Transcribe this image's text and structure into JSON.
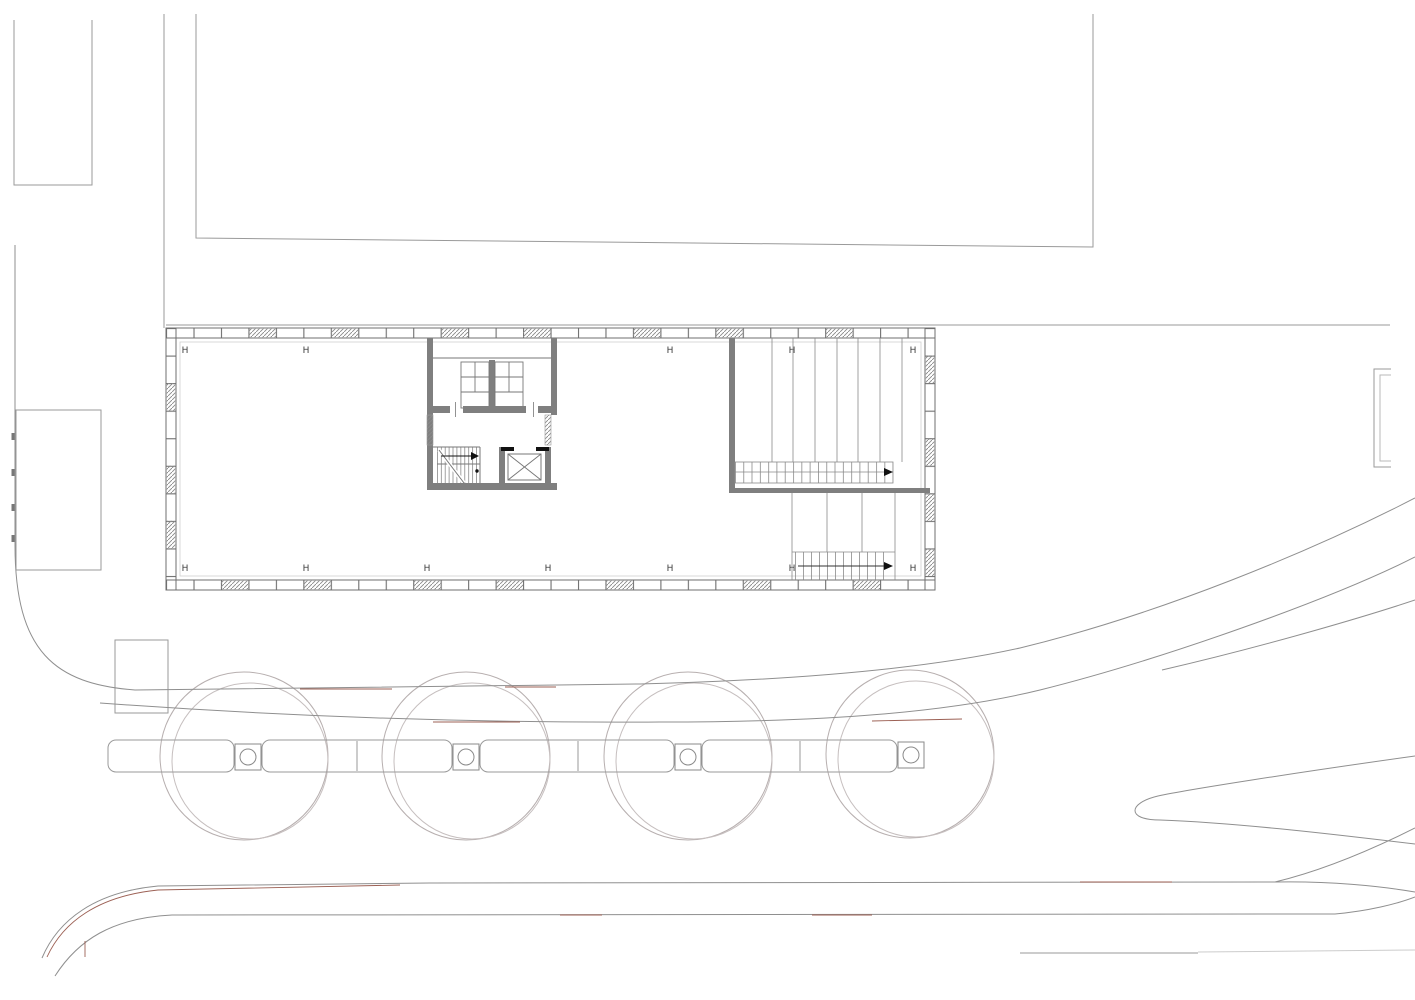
{
  "plan": {
    "title": "floor-plan-site-drawing",
    "grid_marker_label": "H",
    "grid_markers": {
      "top_row": {
        "y": 350,
        "x_positions": [
          185,
          306,
          670,
          792,
          913
        ]
      },
      "bottom_row": {
        "y": 568,
        "x_positions": [
          185,
          306,
          427,
          548,
          670,
          792,
          913
        ]
      }
    },
    "building": {
      "outline": {
        "x": 166,
        "y": 328,
        "width": 769,
        "height": 262
      },
      "core": [
        "wc-room",
        "stair",
        "elevator"
      ],
      "ramps": [
        "ramp-upper",
        "ramp-lower"
      ],
      "facade": "mullion band with hatched panels"
    },
    "site": {
      "tree_count": 4,
      "tree_centers_x": [
        244,
        466,
        688,
        910
      ],
      "tree_row_y": 756,
      "features": [
        "planter-strip",
        "tree-grates",
        "road-edges",
        "traffic-island",
        "upper-building-outline"
      ]
    },
    "colors": {
      "line_gray": "#8f8f8f",
      "light_line_gray": "#b7afaf",
      "wall_gray": "#7f7f7f",
      "black_detail": "#111111",
      "red_accent": "#9c6054",
      "background": "#ffffff"
    }
  }
}
